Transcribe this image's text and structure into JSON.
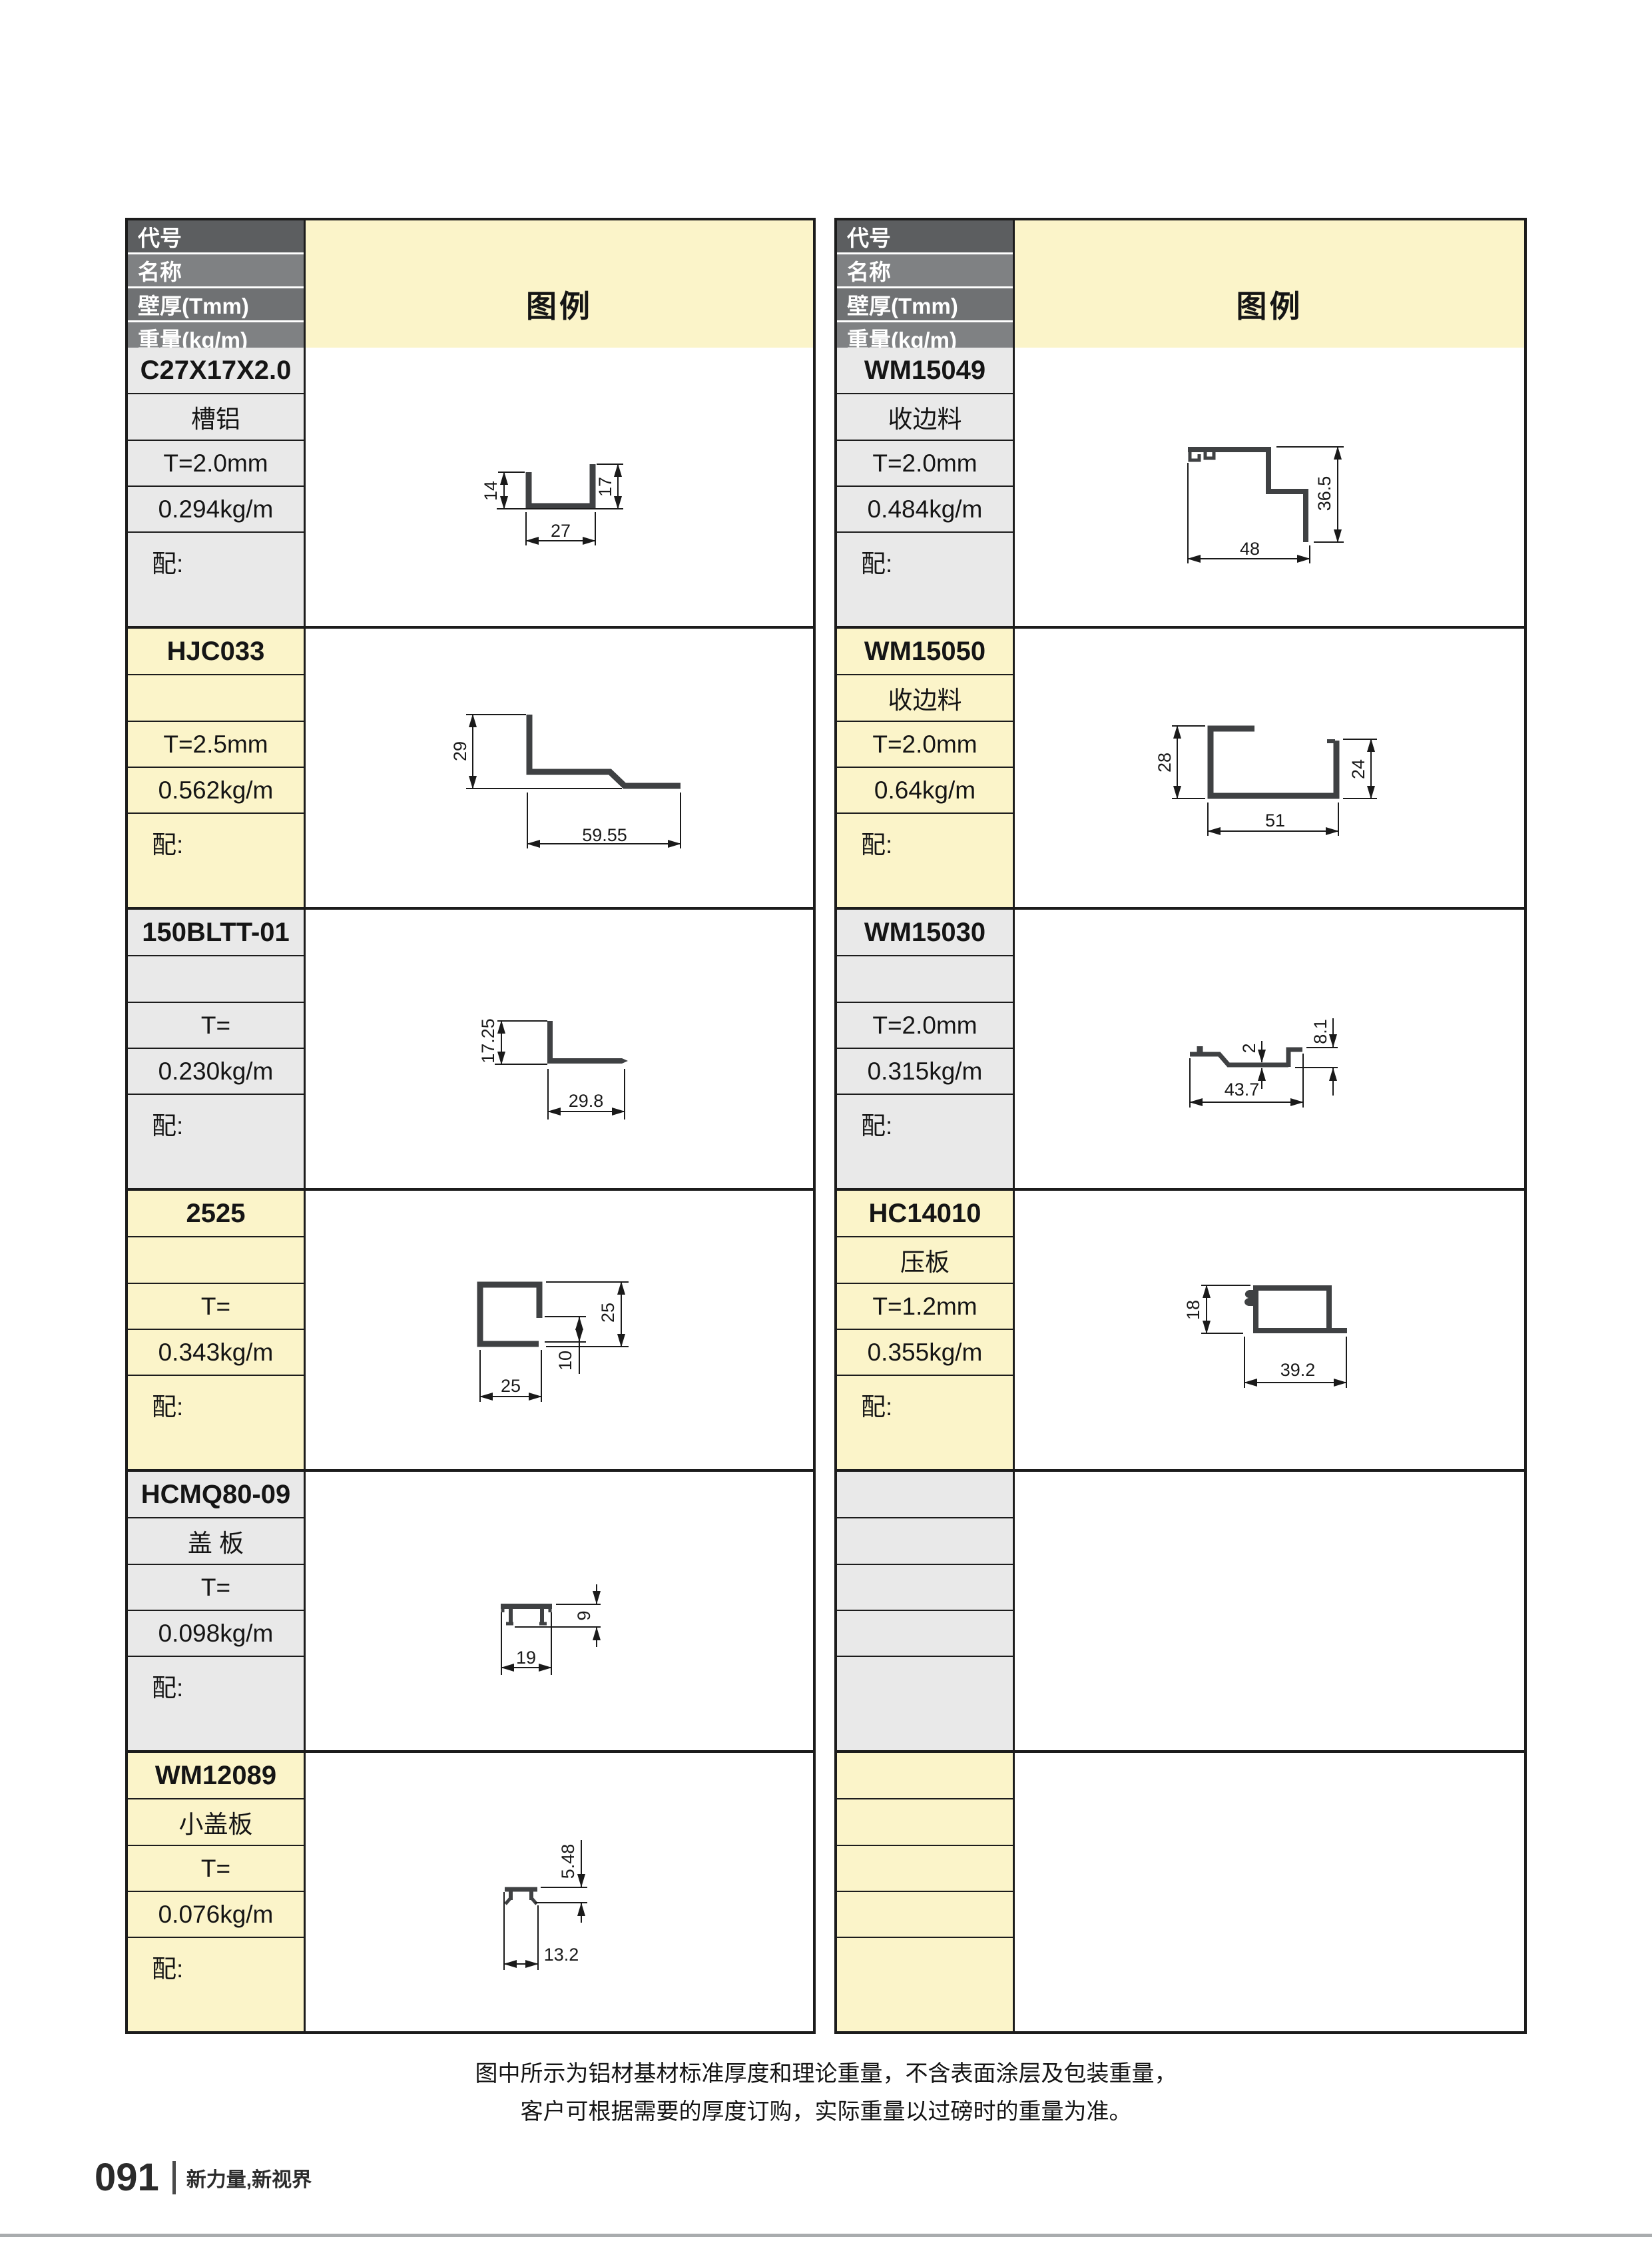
{
  "table_header": {
    "labels": [
      "代号",
      "名称",
      "壁厚(Tmm)",
      "重量(kg/m)",
      "配套"
    ],
    "legend": "图例"
  },
  "left_table": {
    "blocks": [
      {
        "code": "C27X17X2.0",
        "name": "槽铝",
        "thickness": "T=2.0mm",
        "weight": "0.294kg/m",
        "match": "配:",
        "dims": [
          "14",
          "17",
          "27"
        ]
      },
      {
        "code": "HJC033",
        "name": "",
        "thickness": "T=2.5mm",
        "weight": "0.562kg/m",
        "match": "配:",
        "dims": [
          "29",
          "59.55"
        ]
      },
      {
        "code": "150BLTT-01",
        "name": "",
        "thickness": "T=",
        "weight": "0.230kg/m",
        "match": "配:",
        "dims": [
          "17.25",
          "29.8"
        ]
      },
      {
        "code": "2525",
        "name": "",
        "thickness": "T=",
        "weight": "0.343kg/m",
        "match": "配:",
        "dims": [
          "25",
          "10",
          "25"
        ]
      },
      {
        "code": "HCMQ80-09",
        "name": "盖 板",
        "thickness": "T=",
        "weight": "0.098kg/m",
        "match": "配:",
        "dims": [
          "9",
          "19"
        ]
      },
      {
        "code": "WM12089",
        "name": "小盖板",
        "thickness": "T=",
        "weight": "0.076kg/m",
        "match": "配:",
        "dims": [
          "5.48",
          "13.2"
        ]
      }
    ]
  },
  "right_table": {
    "blocks": [
      {
        "code": "WM15049",
        "name": "收边料",
        "thickness": "T=2.0mm",
        "weight": "0.484kg/m",
        "match": "配:",
        "dims": [
          "36.5",
          "48"
        ]
      },
      {
        "code": "WM15050",
        "name": "收边料",
        "thickness": "T=2.0mm",
        "weight": "0.64kg/m",
        "match": "配:",
        "dims": [
          "28",
          "24",
          "51"
        ]
      },
      {
        "code": "WM15030",
        "name": "",
        "thickness": "T=2.0mm",
        "weight": "0.315kg/m",
        "match": "配:",
        "dims": [
          "2",
          "8.1",
          "43.7"
        ]
      },
      {
        "code": "HC14010",
        "name": "压板",
        "thickness": "T=1.2mm",
        "weight": "0.355kg/m",
        "match": "配:",
        "dims": [
          "18",
          "39.2"
        ]
      },
      {
        "code": "",
        "name": "",
        "thickness": "",
        "weight": "",
        "match": "",
        "dims": []
      },
      {
        "code": "",
        "name": "",
        "thickness": "",
        "weight": "",
        "match": "",
        "dims": []
      }
    ]
  },
  "page": {
    "note_lines": [
      "图中所示为铝材基材标准厚度和理论重量，不含表面涂层及包装重量，",
      "客户可根据需要的厚度订购，实际重量以过磅时的重量为准。"
    ],
    "footer": {
      "page_number": "091",
      "tagline": "新力量,新视界"
    }
  },
  "colors": {
    "border": "#1c1c1c",
    "cell_gray": "#e9e9e9",
    "cell_yellow": "#fbf4c9",
    "header_dark": "#5c5e60",
    "header_mid": "#6f7173",
    "header_light": "#7f8183",
    "profile_fill": "#3f4143",
    "dim_line": "#1a1a1a",
    "bottom_rule": "#a9acae",
    "text": "#151515"
  }
}
